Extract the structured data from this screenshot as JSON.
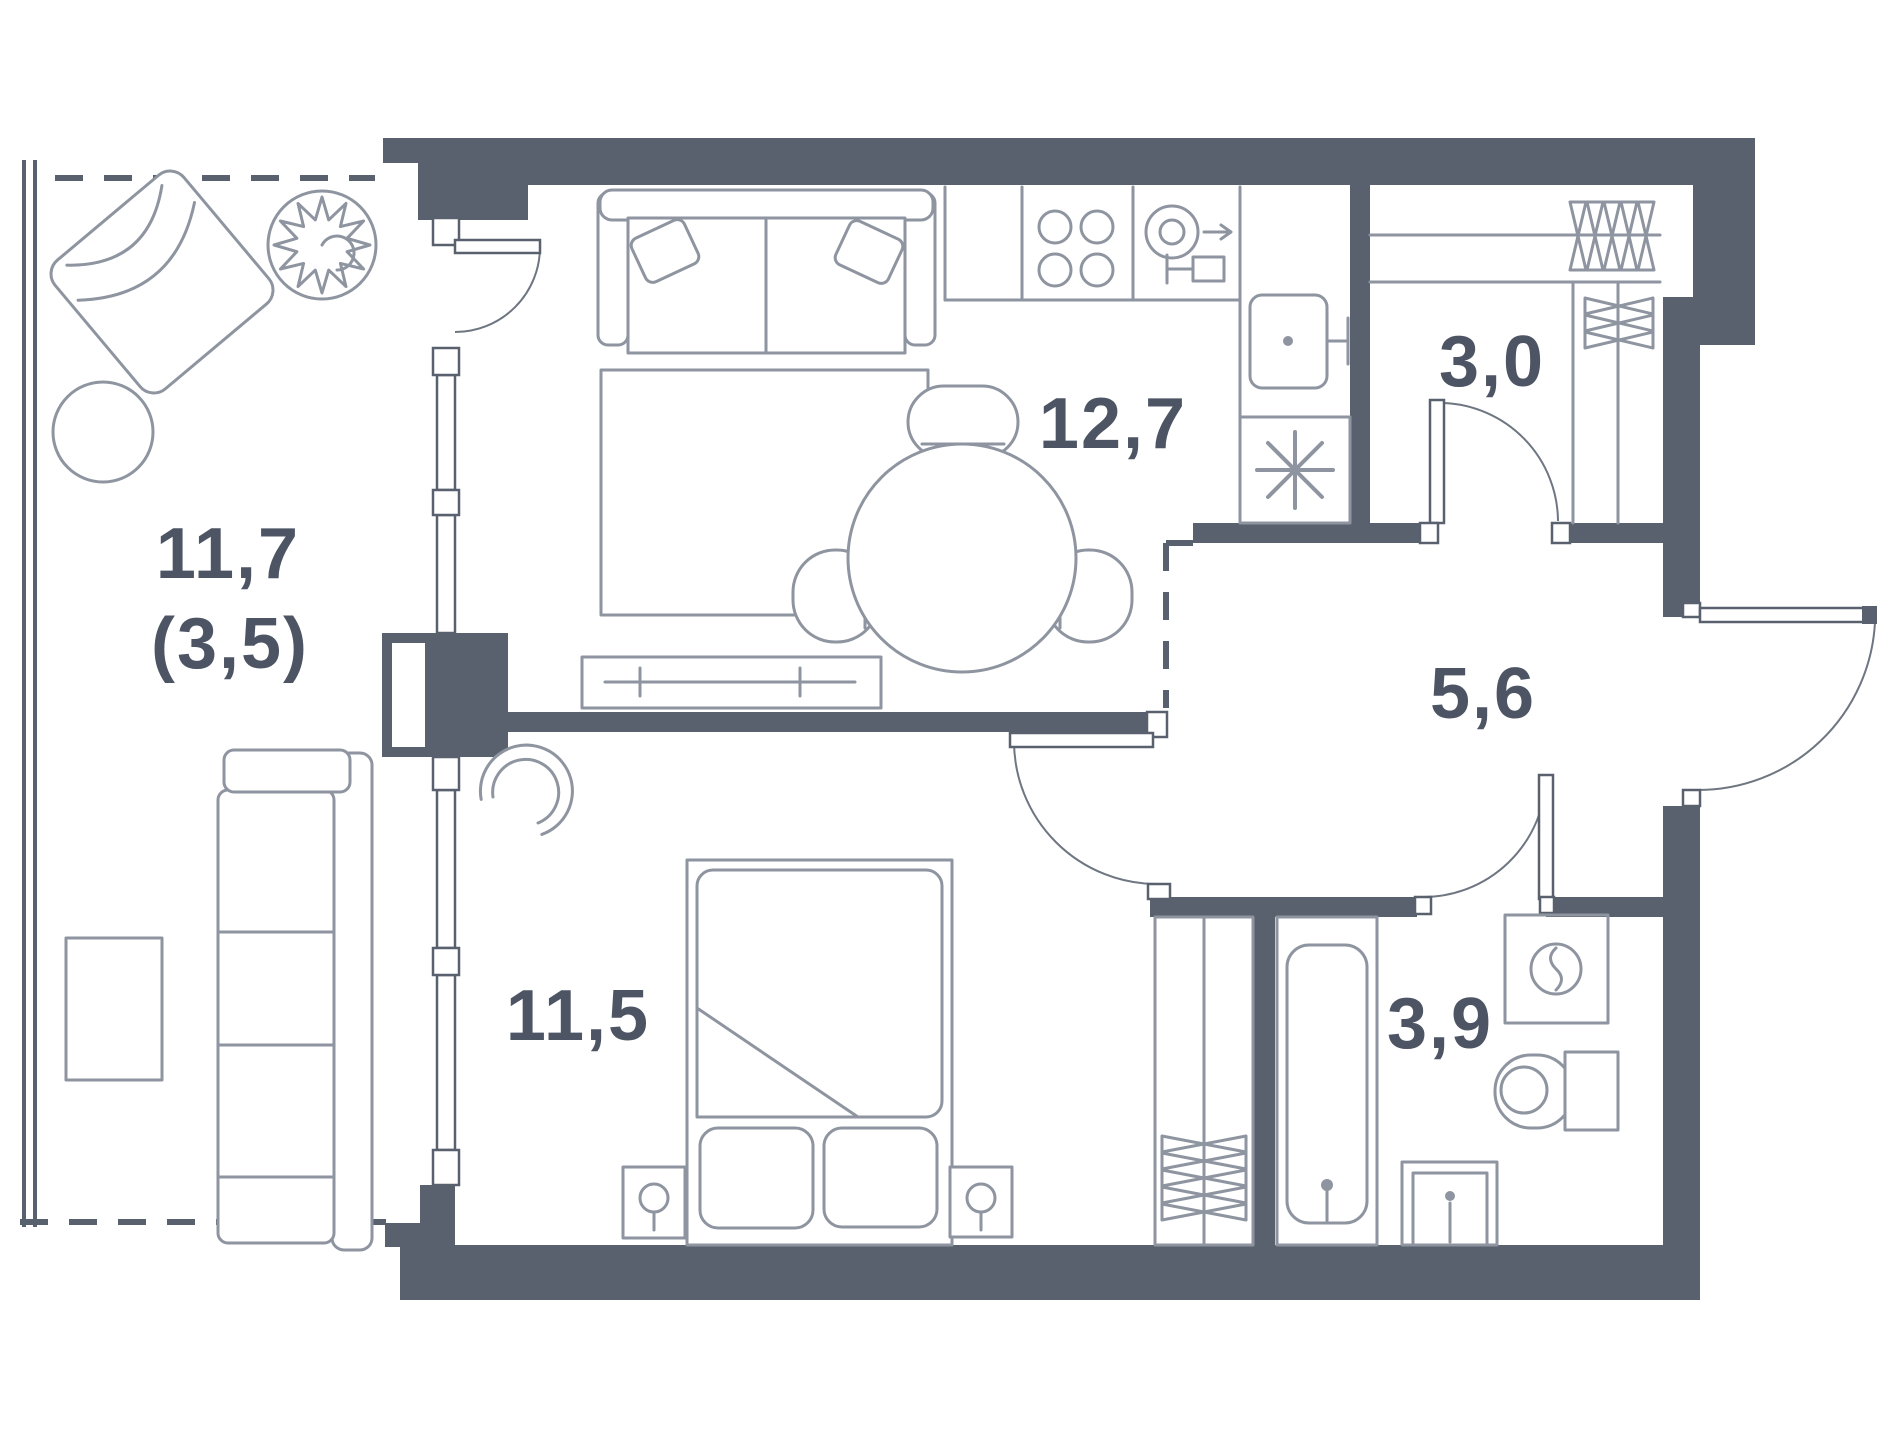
{
  "document": {
    "kind": "apartment-floor-plan",
    "units": "square-meters-with-comma-decimal"
  },
  "colors": {
    "wall": "#59616E",
    "furniture": "#8E95A0",
    "label": "#4D5564",
    "door_arc": "#6E7682",
    "background": "#FFFFFF"
  },
  "rooms": [
    {
      "id": "balcony",
      "name": "balcony-loggia",
      "area": "11,7",
      "area_secondary": "(3,5)"
    },
    {
      "id": "kitchen-living-room",
      "name": "kitchen-living-room",
      "area": "12,7"
    },
    {
      "id": "storage",
      "name": "storage-wardrobe",
      "area": "3,0"
    },
    {
      "id": "hallway",
      "name": "hallway",
      "area": "5,6"
    },
    {
      "id": "bedroom",
      "name": "bedroom",
      "area": "11,5"
    },
    {
      "id": "bathroom",
      "name": "bathroom",
      "area": "3,9"
    }
  ],
  "icons": {
    "fridge": "asterisk-snowflake",
    "stove": "four-burner-circles",
    "hood": "concentric-circles-arrow",
    "kitchen-sink": "basin-with-tap",
    "bathtub": "tub-with-drain",
    "toilet": "bowl-with-tank",
    "washing-machine": "square-with-drum-circle",
    "bathroom-sink": "square-basin-with-tap",
    "hangers": "vertical-bowtie-row",
    "shelves": "horizontal-bowtie-stack",
    "plant": "spiky-foliage-circle",
    "table-lamp": "circle-with-stem"
  }
}
